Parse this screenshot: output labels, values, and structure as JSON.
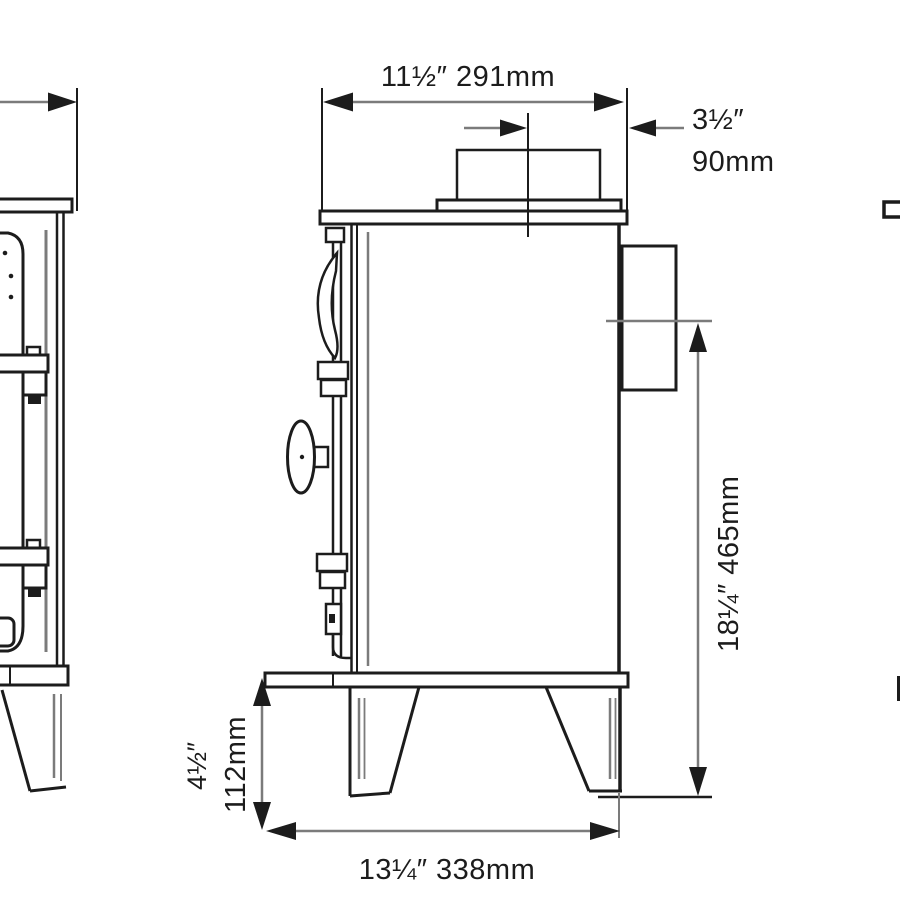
{
  "colors": {
    "background": "#ffffff",
    "line": "#1c1c1c",
    "dim_line": "#7b7b7b"
  },
  "dims": {
    "top_width": "11½″ 291mm",
    "flue_offset_in": "3½″",
    "flue_offset_mm": "90mm",
    "height": "18¼″ 465mm",
    "leg_height_in": "4½″",
    "leg_height_mm": "112mm",
    "base_width": "13¼″ 338mm"
  }
}
